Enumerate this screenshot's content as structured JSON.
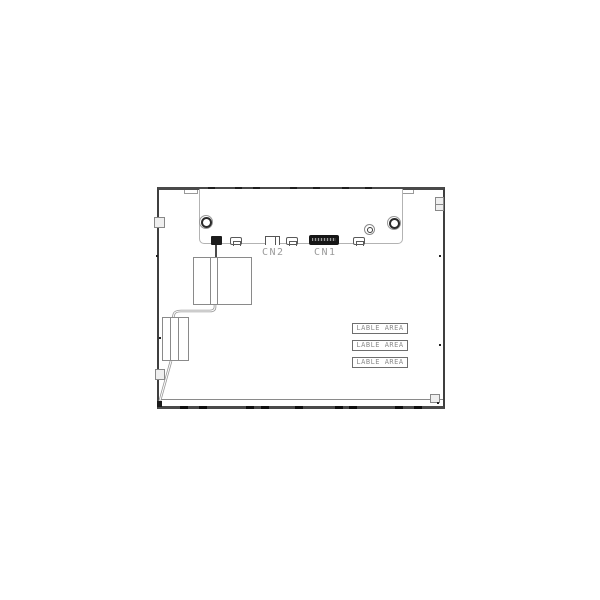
{
  "drawing": {
    "connector_labels": {
      "cn2": "CN2",
      "cn1": "CN1"
    },
    "label_areas": [
      "LABLE AREA",
      "LABLE AREA",
      "LABLE AREA"
    ],
    "colors": {
      "outline_dark": "#3f3f3f",
      "outline_light": "#b3b3b3",
      "connector_fill": "#161616",
      "annotation_text": "#9b9b9b",
      "label_text": "#8c8c8c",
      "background": "#ffffff"
    }
  }
}
